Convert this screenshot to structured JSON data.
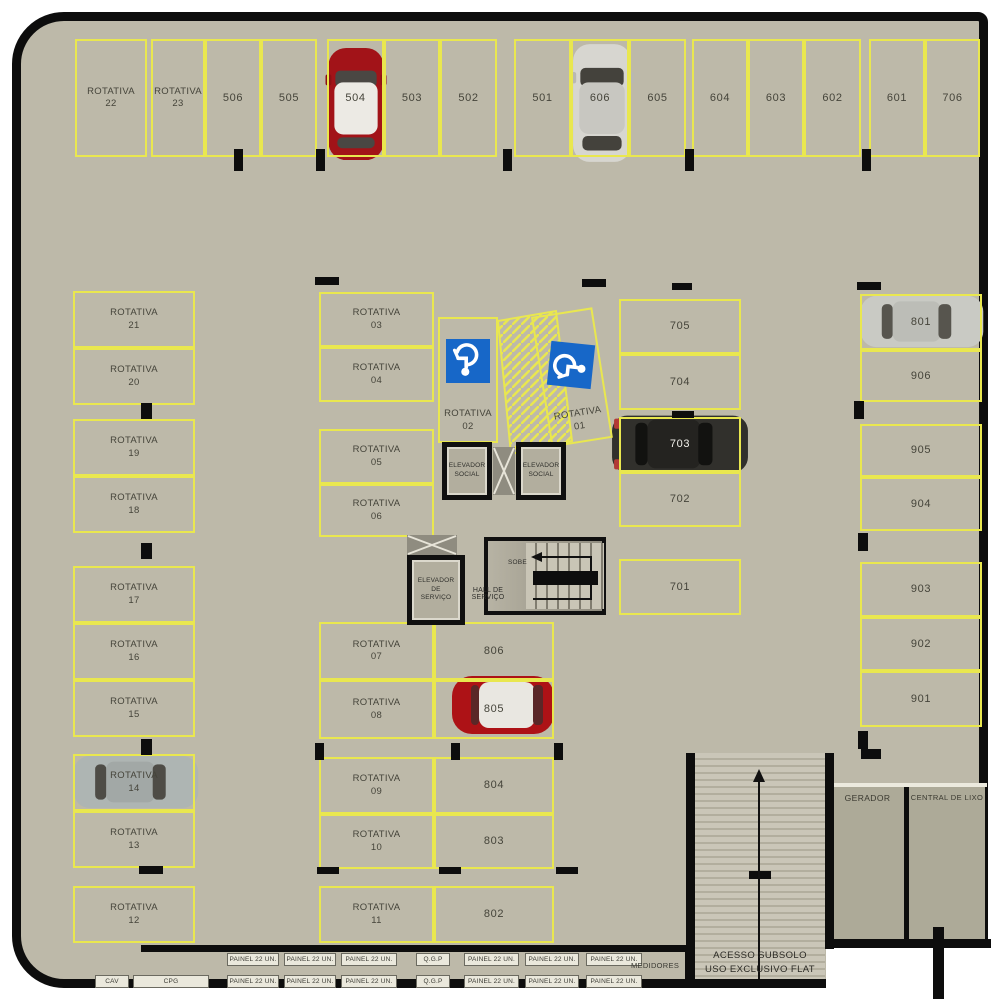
{
  "stalls": {
    "top_row": [
      "ROTATIVA\n22",
      "ROTATIVA\n23",
      "506",
      "505",
      "504",
      "503",
      "502",
      "501",
      "606",
      "605",
      "604",
      "603",
      "602",
      "601",
      "706"
    ],
    "left_col": [
      "ROTATIVA\n21",
      "ROTATIVA\n20",
      "ROTATIVA\n19",
      "ROTATIVA\n18",
      "ROTATIVA\n17",
      "ROTATIVA\n16",
      "ROTATIVA\n15",
      "ROTATIVA\n14",
      "ROTATIVA\n13",
      "ROTATIVA\n12"
    ],
    "center_col": [
      "ROTATIVA\n03",
      "ROTATIVA\n04",
      "ROTATIVA\n05",
      "ROTATIVA\n06",
      "ROTATIVA\n07",
      "ROTATIVA\n08",
      "ROTATIVA\n09",
      "ROTATIVA\n10",
      "ROTATIVA\n11"
    ],
    "flat_col": [
      "806",
      "805",
      "804",
      "803",
      "802"
    ],
    "accessible": [
      "ROTATIVA\n02",
      "ROTATIVA\n01"
    ],
    "east_inner_col": [
      "705",
      "704",
      "703",
      "702",
      "701"
    ],
    "east_col": [
      "801",
      "906",
      "905",
      "904",
      "903",
      "902",
      "901"
    ]
  },
  "core": {
    "elevator_social": "ELEVADOR\nSOCIAL",
    "elevator_service": "ELEVADOR\nDE\nSERVIÇO",
    "hall": "HALL DE\nSERVIÇO",
    "stairs_up": "SOBE"
  },
  "bottom": {
    "ramp": "ACESSO SUBSOLO\nUSO EXCLUSIVO FLAT",
    "generator": "GERADOR",
    "trash": "CENTRAL DE LIXO",
    "meters": "MEDIDORES",
    "panel": "PAINEL 22 UN.",
    "qgp": "Q.G.P",
    "cpg": "CPG",
    "cav": "CAV"
  },
  "cars": [
    {
      "stall": "504",
      "color": "#a21318"
    },
    {
      "stall": "606",
      "color": "#d7d6d0"
    },
    {
      "stall": "703",
      "color": "#31302c"
    },
    {
      "stall": "801",
      "color": "#c9cac4"
    },
    {
      "stall": "805",
      "color": "#ad1216"
    },
    {
      "stall": "ROTATIVA 14",
      "color": "#aeb5b3"
    }
  ],
  "colors": {
    "floor": "#bdb9a9",
    "stall_line": "#e9e74f",
    "wall": "#0d0d0d",
    "accessible_blue": "#1767c8",
    "car_red": "#a21318",
    "car_silver": "#c9cac4",
    "car_dark": "#31302c",
    "ramp_floor": "#c6c2b4"
  }
}
